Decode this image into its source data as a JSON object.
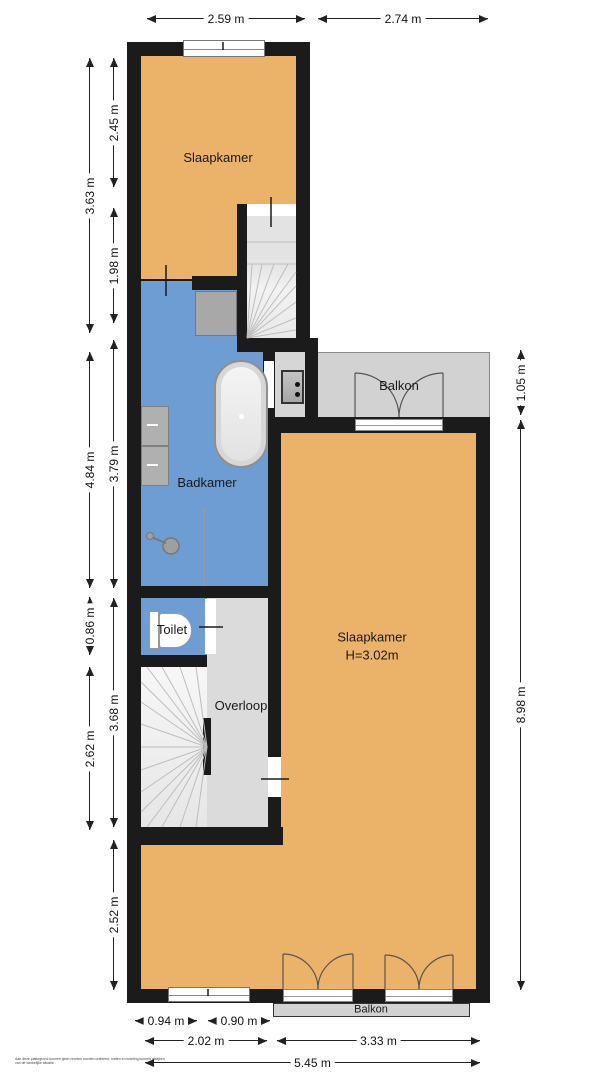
{
  "title": "Floor plan (verdieping)",
  "colors": {
    "wall": "#1b1b1b",
    "orange": "#EBB26A",
    "blue": "#6E9DD3",
    "balcony": "#D2D2D2",
    "hall": "#DBDBDB",
    "fixture": "#A8A8A8",
    "dimtext": "#111111"
  },
  "rooms": {
    "bedroom_top": "Slaapkamer",
    "bathroom": "Badkamer",
    "toilet": "Toilet",
    "landing": "Overloop",
    "bedroom_main_line1": "Slaapkamer",
    "bedroom_main_line2": "H=3.02m",
    "balcony_top": "Balkon",
    "balcony_bottom": "Balkon"
  },
  "dims": {
    "top_left": "2.59 m",
    "top_right": "2.74 m",
    "left_outer_1": "3.63 m",
    "left_outer_2": "4.84 m",
    "left_outer_3": "0.86 m",
    "left_outer_4": "2.62 m",
    "left_inner_1": "2.45 m",
    "left_inner_2": "1.98 m",
    "left_inner_3": "3.79 m",
    "left_inner_4": "3.68 m",
    "left_inner_5": "2.52 m",
    "right_1": "1.05 m",
    "right_2": "8.98 m",
    "bottom_small_1": "0.94 m",
    "bottom_small_2": "0.90 m",
    "bottom_mid_1": "2.02 m",
    "bottom_mid_2": "3.33 m",
    "bottom_total": "5.45 m"
  },
  "disclaimer": "Aan deze plattegrond kunnen geen rechten worden ontleend, maten en indeling kunnen afwijken van de werkelijke situatie"
}
